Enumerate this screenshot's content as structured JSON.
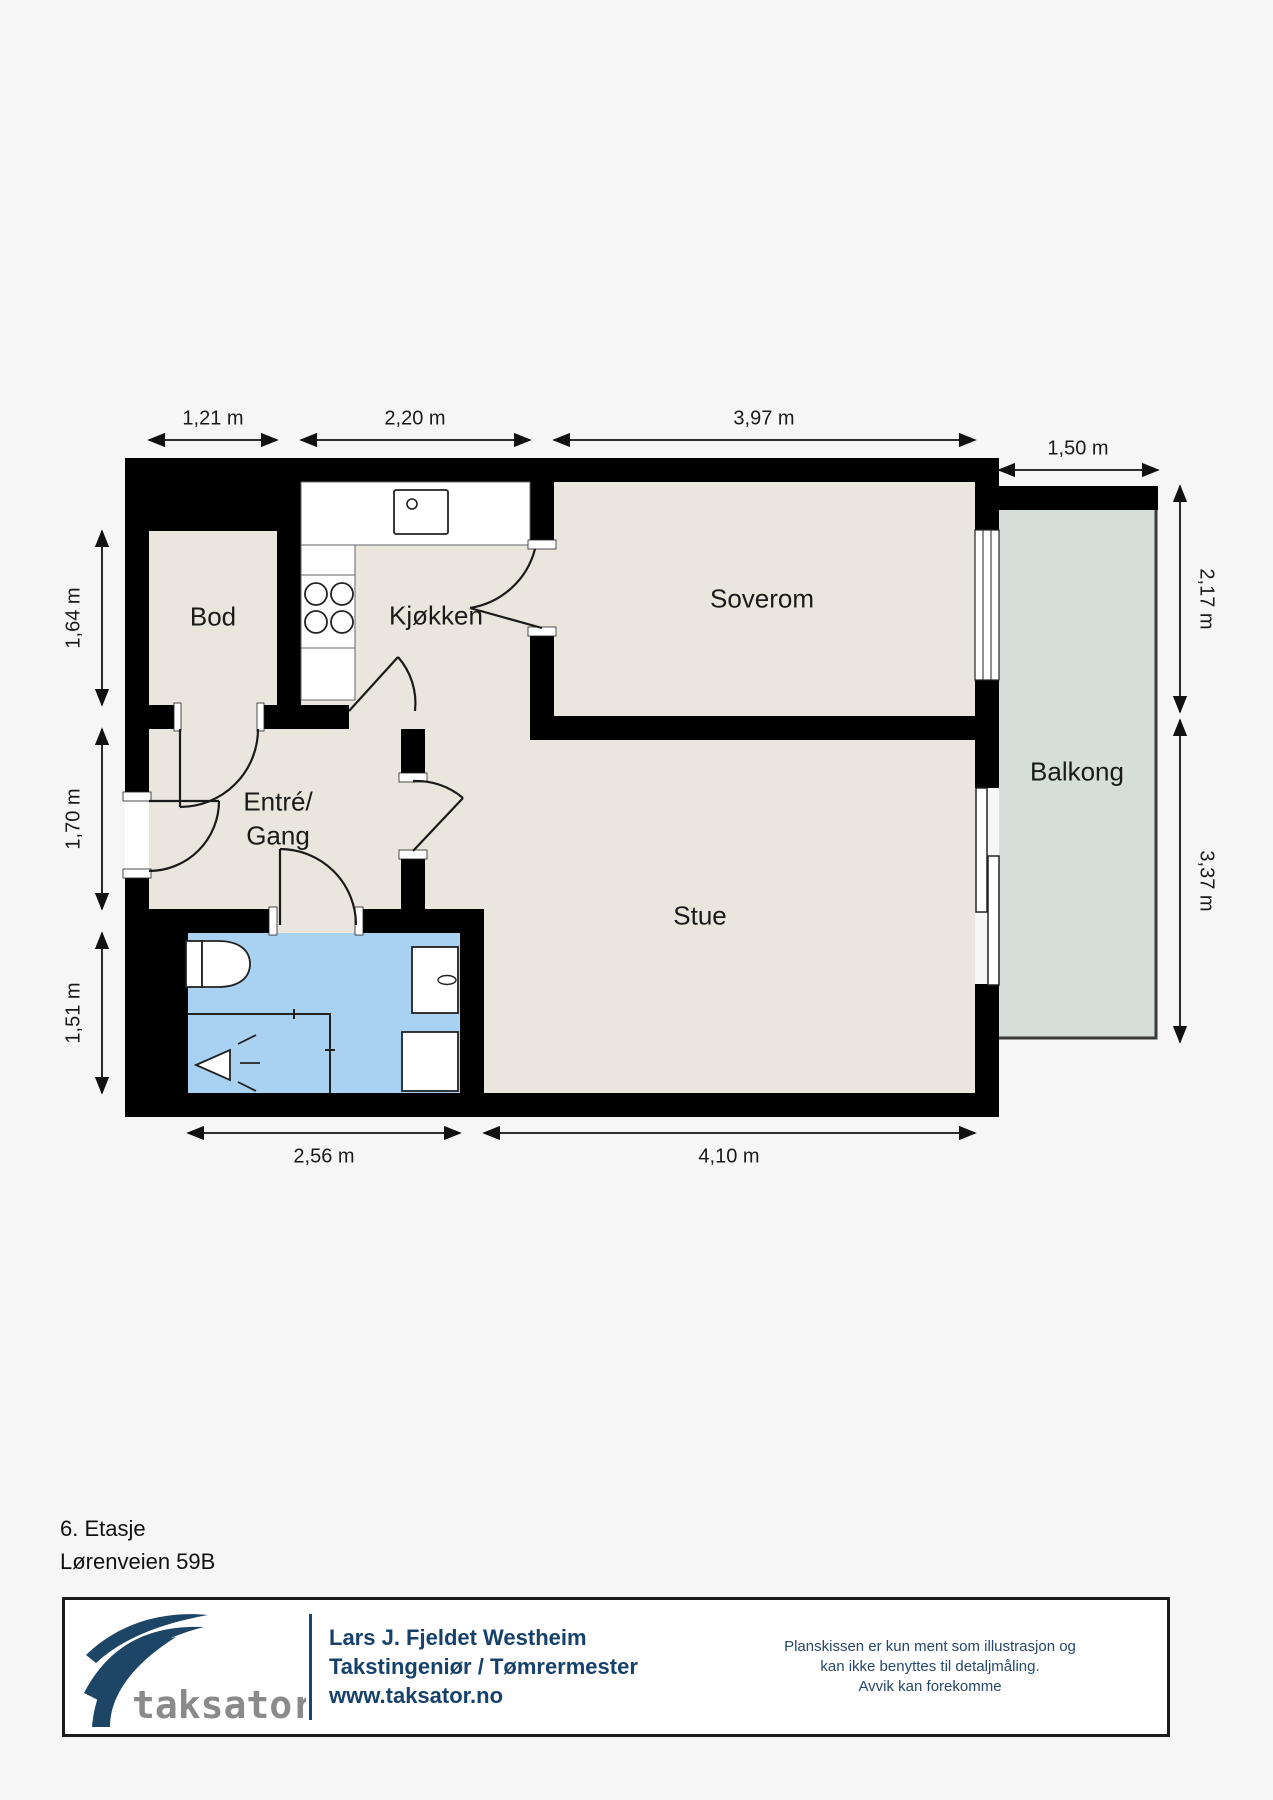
{
  "floor_info": {
    "floor_label": "6. Etasje",
    "address": "Lørenveien 59B"
  },
  "rooms": {
    "bod": "Bod",
    "kjokken": "Kjøkken",
    "soverom": "Soverom",
    "entre_line1": "Entré/",
    "entre_line2": "Gang",
    "stue": "Stue",
    "balkong": "Balkong"
  },
  "dimensions": {
    "top": [
      "1,21 m",
      "2,20 m",
      "3,97 m"
    ],
    "balcony_width": "1,50 m",
    "left": [
      "1,64 m",
      "1,70 m",
      "1,51 m"
    ],
    "right": [
      "2,17 m",
      "3,37 m"
    ],
    "bottom": [
      "2,56 m",
      "4,10 m"
    ]
  },
  "footer": {
    "logo_text": "taksator",
    "name": "Lars J. Fjeldet Westheim",
    "title": "Takstingeniør / Tømrermester",
    "website": "www.taksator.no",
    "disclaimer_line1": "Planskissen er kun ment som illustrasjon og",
    "disclaimer_line2": "kan ikke benyttes til detaljmåling.",
    "disclaimer_line3": "Avvik kan forekomme"
  },
  "colors": {
    "wall": "#000000",
    "floor": "#eae6dd",
    "balcony": "#d5ded8",
    "bathroom": "#a9d2f2",
    "navy": "#1c4566",
    "logo_gray": "#8a8a8a"
  }
}
